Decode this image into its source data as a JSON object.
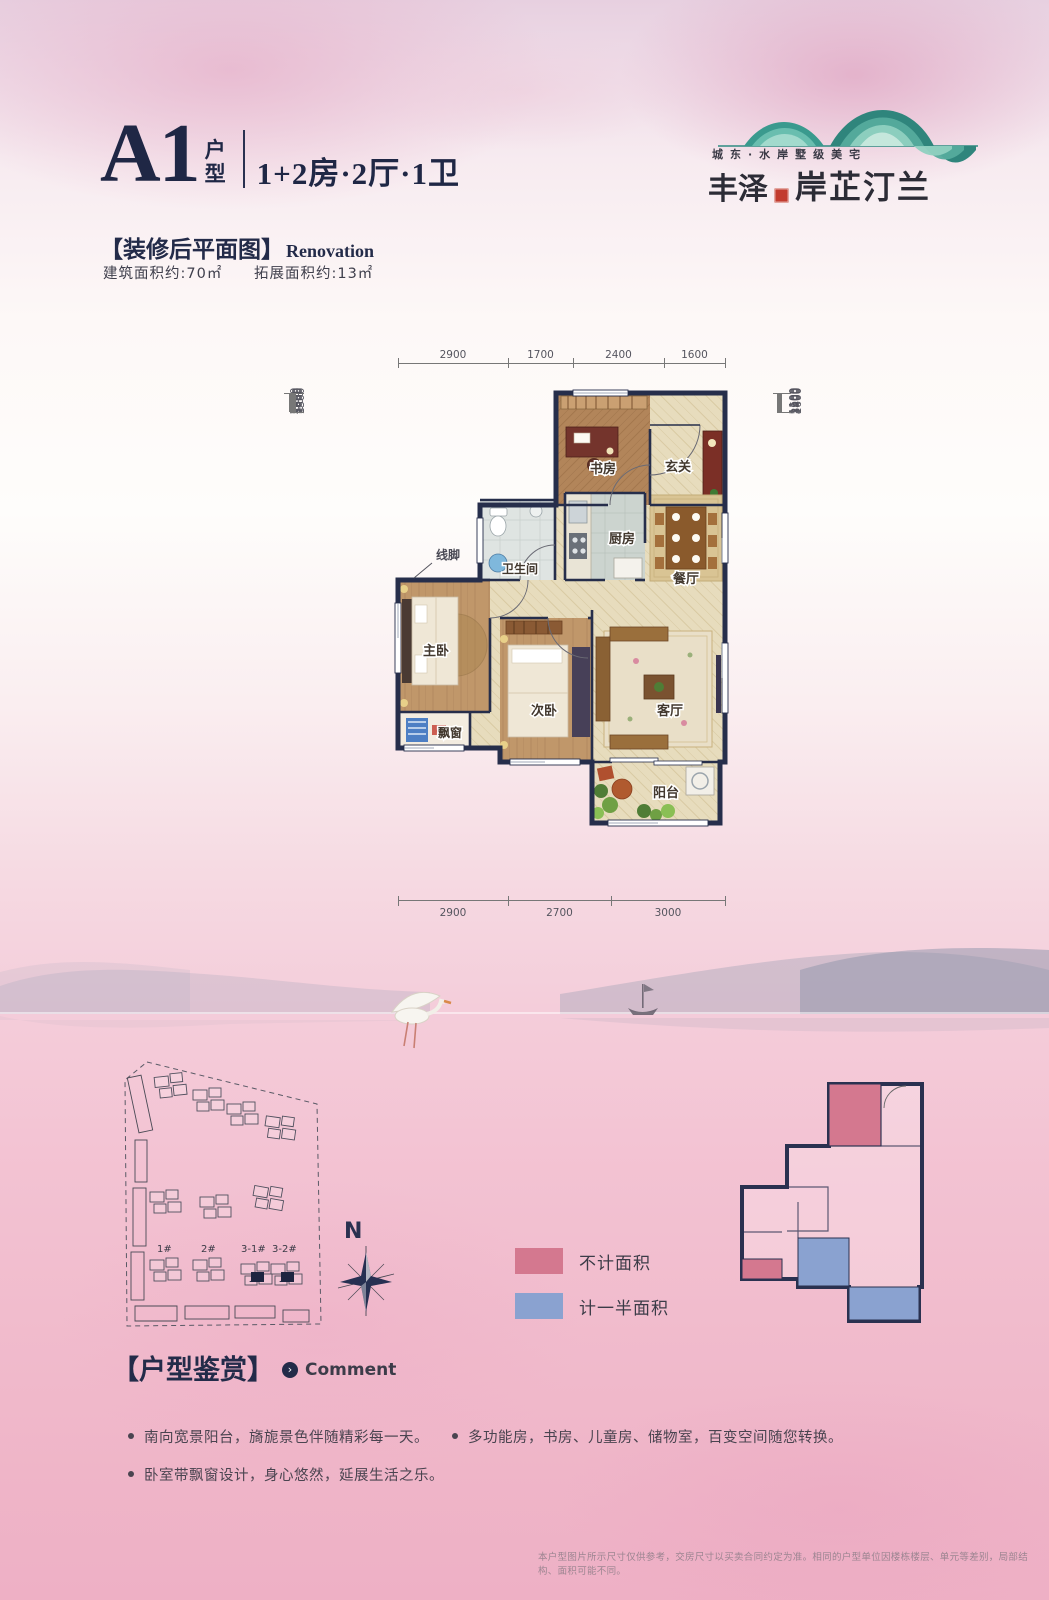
{
  "header": {
    "unit_code": "A1",
    "unit_type_label": "户型",
    "unit_spec": "1+2房·2厅·1卫"
  },
  "logo": {
    "tagline": "城东·水岸墅级美宅",
    "brand_primary": "丰泽",
    "brand_secondary": "岸芷汀兰"
  },
  "plan_section": {
    "title_cn": "【装修后平面图】",
    "title_en": "Renovation",
    "area_built": "建筑面积约:70㎡",
    "area_extended": "拓展面积约:13㎡"
  },
  "floorplan": {
    "dims_top": [
      "2900",
      "1700",
      "2400",
      "1600"
    ],
    "dims_bottom": [
      "2900",
      "2700",
      "3000"
    ],
    "dims_left": [
      "2600",
      "800",
      "1800",
      "1300",
      "1000",
      "900",
      "1300"
    ],
    "dims_right": [
      "1100",
      "1500",
      "3900",
      "3400",
      "1600"
    ],
    "rooms": [
      {
        "label": "书房"
      },
      {
        "label": "玄关"
      },
      {
        "label": "卫生间"
      },
      {
        "label": "厨房"
      },
      {
        "label": "餐厅"
      },
      {
        "label": "主卧"
      },
      {
        "label": "次卧"
      },
      {
        "label": "客厅"
      },
      {
        "label": "飘窗"
      },
      {
        "label": "阳台"
      }
    ],
    "annotation_molding": "线脚"
  },
  "site_plan": {
    "building_labels": [
      "1#",
      "2#",
      "3-1#",
      "3-2#"
    ],
    "compass_label": "N"
  },
  "legend": {
    "items": [
      {
        "label": "不计面积",
        "color": "#d4788f"
      },
      {
        "label": "计一半面积",
        "color": "#8aa2d0"
      }
    ]
  },
  "comment": {
    "title_cn": "【户型鉴赏】",
    "title_en": "Comment",
    "bullets_left": [
      "南向宽景阳台，旖旎景色伴随精彩每一天。",
      "卧室带飘窗设计，身心悠然，延展生活之乐。"
    ],
    "bullets_right": [
      "多功能房，书房、儿童房、储物室，百变空间随您转换。"
    ]
  },
  "footer": {
    "disclaimer": "本户型图片所示尺寸仅供参考，交房尺寸以买卖合同约定为准。相同的户型单位因楼栋楼层、单元等差别，局部结构、面积可能不同。"
  },
  "colors": {
    "accent_navy": "#262e4b",
    "brand_teal": "#3a9a8e",
    "legend_pink": "#d4788f",
    "legend_blue": "#8aa2d0"
  }
}
